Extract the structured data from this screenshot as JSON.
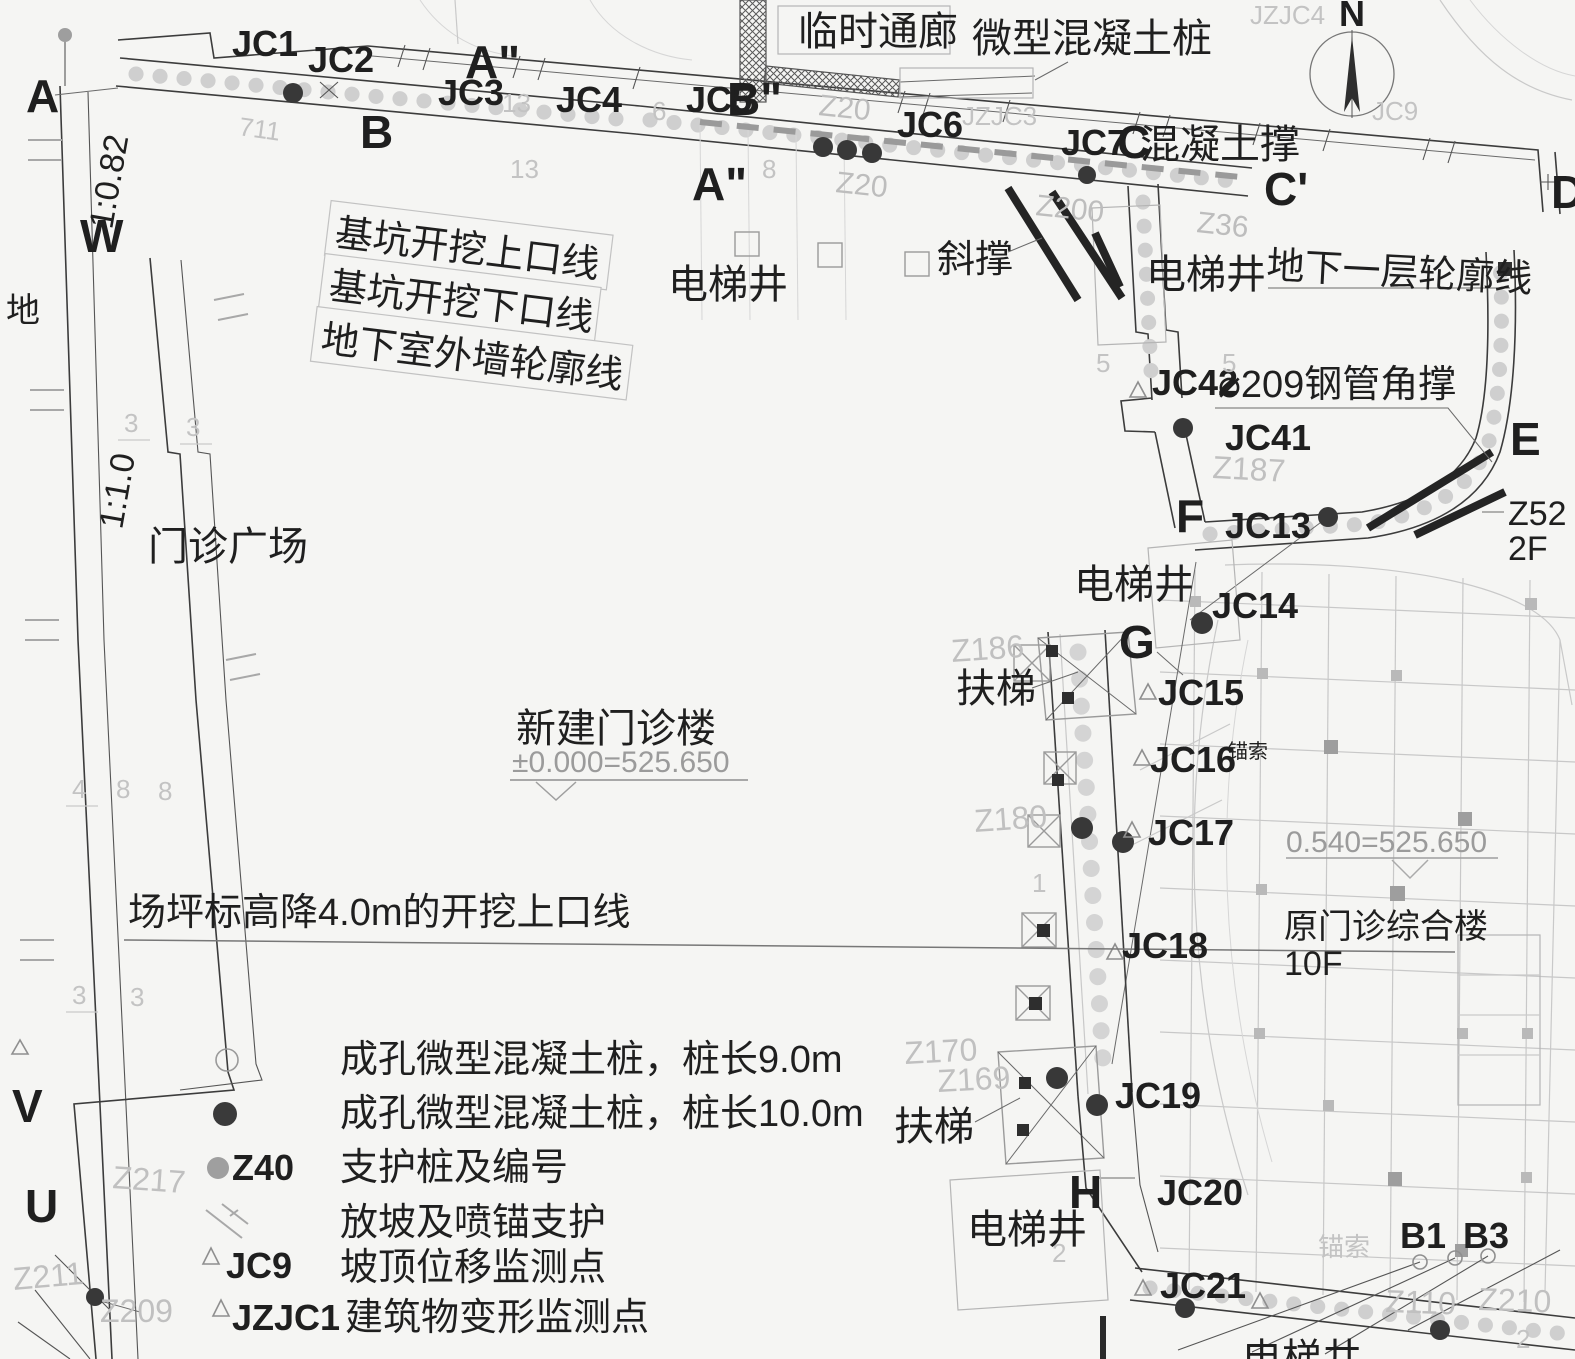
{
  "canvas": {
    "bg": "#f5f5f3"
  },
  "compass": {
    "north": "N"
  },
  "sections": {
    "a": "A",
    "a_top": "A\"",
    "a_mid": "A\"",
    "b": "B",
    "b_top": "B\"",
    "c": "C",
    "c_prime": "C'",
    "d": "D",
    "e": "E",
    "f": "F",
    "g": "G",
    "h": "H",
    "u": "U",
    "v": "V",
    "w": "W"
  },
  "jc": {
    "jc1": "JC1",
    "jc2": "JC2",
    "jc3": "JC3",
    "jc4": "JC4",
    "jc5": "JC5",
    "jc6": "JC6",
    "jc7": "JC7",
    "jc13": "JC13",
    "jc14": "JC14",
    "jc15": "JC15",
    "jc16": "JC16",
    "jc17": "JC17",
    "jc18": "JC18",
    "jc19": "JC19",
    "jc20": "JC20",
    "jc21": "JC21",
    "jc41": "JC41",
    "jc42": "JC42"
  },
  "notes": {
    "temp_corridor": "临时通廊",
    "micro_pile": "微型混凝土桩",
    "concrete_brace": "混凝土撑",
    "diagonal_brace": "斜撑",
    "elevator": "电梯井",
    "basement_outline": "地下一层轮廓线",
    "pit_top_line": "基坑开挖上口线",
    "pit_bottom_line": "基坑开挖下口线",
    "basement_wall_line": "地下室外墙轮廓线",
    "steel_pipe_brace": "⌀209钢管角撑",
    "plaza": "门诊广场",
    "new_building": "新建门诊楼",
    "new_building_level": "±0.000=525.650",
    "escalator": "扶梯",
    "anchor_cable": "锚索",
    "ground_level": "0.540=525.650",
    "site_cut_line": "场坪标高降4.0m的开挖上口线",
    "old_building": "原门诊综合楼",
    "old_building_floors": "10F",
    "z52": "Z52",
    "floor2": "2F",
    "slope_1": "1:0.82",
    "slope_2": "1:1.0",
    "ground_char": "地",
    "b1": "B1",
    "b3": "B3"
  },
  "legend": {
    "rows": [
      {
        "code": "",
        "label": "成孔微型混凝土桩，桩长9.0m"
      },
      {
        "code": "",
        "label": "成孔微型混凝土桩，桩长10.0m"
      },
      {
        "code": "Z40",
        "label": "支护桩及编号"
      },
      {
        "code": "",
        "label": "放坡及喷锚支护"
      },
      {
        "code": "JC9",
        "label": "坡顶位移监测点"
      },
      {
        "code": "JZJC1",
        "label": "建筑物变形监测点"
      }
    ]
  },
  "faint": {
    "z217": "Z217",
    "z211": "Z211",
    "z209": "Z209",
    "z169": "Z169",
    "z170": "Z170",
    "z180": "Z180",
    "z186": "Z186",
    "z187": "Z187",
    "z200": "Z200",
    "z210": "Z210",
    "z110": "Z110",
    "z20a": "Z20",
    "z20b": "Z20",
    "z36": "Z36",
    "jzjc3": "JZJC3",
    "jzjc4": "JZJC4",
    "jc9": "JC9",
    "anchor_faint": "锚索",
    "n711": "711",
    "n13a": "13",
    "n13b": "13",
    "n6": "6",
    "n5a": "5",
    "n5b": "5",
    "n3a": "3",
    "n3b": "3",
    "n3c": "3",
    "n3d": "3",
    "n4": "4",
    "n8a": "8",
    "n8b": "8",
    "n8c": "8",
    "n2a": "2",
    "n2b": "2",
    "n1": "1"
  }
}
